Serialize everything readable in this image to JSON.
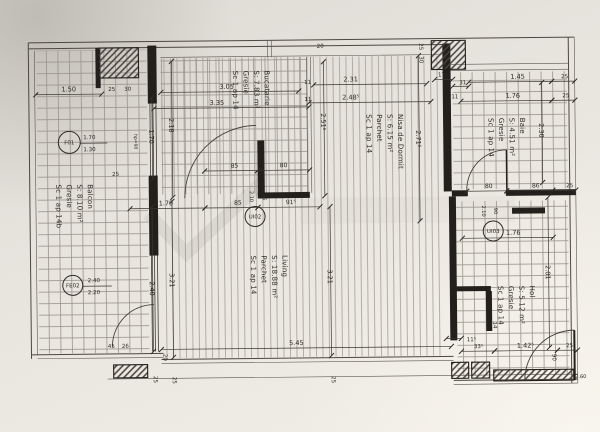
{
  "rooms": [
    {
      "id": "balcon",
      "name": "Balcon",
      "area": "S: 8.10 m²",
      "floor": "Gresie",
      "scale": "Sc 1 ap 14b",
      "x": 88,
      "y": 182
    },
    {
      "id": "bucatarie",
      "name": "Bucatarie",
      "area": "S: 7.83 m²",
      "floor": "Gresie",
      "scale": "Sc 1 ap 14",
      "x": 266,
      "y": 70
    },
    {
      "id": "nisa-de-dormit",
      "name": "Nisa de Dormit",
      "area": "S: 6.15 m²",
      "floor": "Parchet",
      "scale": "Sc 1 ap 14",
      "x": 399,
      "y": 115
    },
    {
      "id": "baie",
      "name": "Baie",
      "area": "S: 4.51 m²",
      "floor": "Gresie",
      "scale": "Sc 1 ap 14",
      "x": 521,
      "y": 120
    },
    {
      "id": "living",
      "name": "Living",
      "area": "S: 18.88 m²",
      "floor": "Parchet",
      "scale": "Sc 1 ap 14",
      "x": 282,
      "y": 255
    },
    {
      "id": "hol",
      "name": "Hol",
      "area": "S: 5.12 m²",
      "floor": "Gresie",
      "scale": "Sc 1 ap 14",
      "x": 529,
      "y": 288
    }
  ],
  "openings": [
    {
      "id": "F01",
      "cx": 70,
      "cy": 140,
      "r": 11,
      "spec": [
        "1.70",
        "1.30"
      ],
      "sx": 84
    },
    {
      "id": "FE02",
      "cx": 72,
      "cy": 283,
      "r": 10,
      "spec": [
        "2.40",
        "2.20"
      ],
      "sx": 87
    },
    {
      "id": "UI02",
      "cx": 255,
      "cy": 216,
      "r": 10
    },
    {
      "id": "UI03",
      "cx": 493,
      "cy": 233,
      "r": 10
    }
  ],
  "dims": [
    {
      "v": "1.50",
      "x1": 37,
      "y1": 92,
      "x2": 103,
      "y2": 92,
      "tx": 70,
      "ty": 89
    },
    {
      "v": "25",
      "tx": 113,
      "ty": 89,
      "s": 5.5
    },
    {
      "v": "30",
      "tx": 129,
      "ty": 89,
      "s": 5.5
    },
    {
      "v": "3.05",
      "x1": 162,
      "y1": 91,
      "x2": 300,
      "y2": 91,
      "tx": 228,
      "ty": 88
    },
    {
      "v": "3.35",
      "x1": 155,
      "y1": 107,
      "x2": 310,
      "y2": 107,
      "tx": 218,
      "ty": 104
    },
    {
      "v": "2.31",
      "x1": 315,
      "y1": 85,
      "x2": 428,
      "y2": 85,
      "tx": 352,
      "ty": 82
    },
    {
      "v": "2.48⁵",
      "x1": 310,
      "y1": 103,
      "x2": 432,
      "y2": 103,
      "tx": 352,
      "ty": 100
    },
    {
      "v": "20",
      "tx": 322,
      "ty": 48,
      "s": 5.5
    },
    {
      "v": "11",
      "tx": 309,
      "ty": 84,
      "s": 5.5
    },
    {
      "v": "11",
      "tx": 309,
      "ty": 101,
      "s": 5.5
    },
    {
      "v": "25",
      "tx": 421,
      "ty": 48,
      "r": 90,
      "s": 5.5
    },
    {
      "v": "30",
      "tx": 421,
      "ty": 61,
      "r": 90,
      "s": 5.5
    },
    {
      "v": "17⁵",
      "x1": 436,
      "y1": 81,
      "x2": 454,
      "y2": 81,
      "tx": 444,
      "ty": 78,
      "s": 5.5
    },
    {
      "v": "31",
      "x1": 454,
      "y1": 88,
      "x2": 470,
      "y2": 88,
      "tx": 464,
      "ty": 86,
      "s": 5.5
    },
    {
      "v": "11",
      "tx": 456,
      "ty": 100,
      "s": 5.5
    },
    {
      "v": "1.45",
      "x1": 470,
      "y1": 84,
      "x2": 553,
      "y2": 84,
      "tx": 519,
      "ty": 81
    },
    {
      "v": "25",
      "x1": 553,
      "y1": 84,
      "x2": 576,
      "y2": 84,
      "tx": 566,
      "ty": 81,
      "s": 5.5
    },
    {
      "v": "1.76",
      "x1": 462,
      "y1": 103,
      "x2": 553,
      "y2": 103,
      "tx": 514,
      "ty": 100
    },
    {
      "v": "25",
      "x1": 553,
      "y1": 103,
      "x2": 576,
      "y2": 103,
      "tx": 567,
      "ty": 100,
      "s": 5.5
    },
    {
      "v": "2.30",
      "x1": 543,
      "y1": 85,
      "x2": 543,
      "y2": 185,
      "tx": 540,
      "ty": 133,
      "r": 90
    },
    {
      "v": "80",
      "x1": 467,
      "y1": 193,
      "x2": 507,
      "y2": 193,
      "tx": 489,
      "ty": 190,
      "s": 6
    },
    {
      "v": "86",
      "x1": 507,
      "y1": 193,
      "x2": 553,
      "y2": 193,
      "tx": 536,
      "ty": 190,
      "s": 6
    },
    {
      "v": "25",
      "x1": 553,
      "y1": 193,
      "x2": 576,
      "y2": 193,
      "tx": 570,
      "ty": 190,
      "s": 5.5
    },
    {
      "v": "2.51⁵",
      "x1": 325,
      "y1": 62,
      "x2": 325,
      "y2": 196,
      "tx": 322,
      "ty": 122,
      "r": 90
    },
    {
      "v": "2.71⁵",
      "x1": 420,
      "y1": 57,
      "x2": 420,
      "y2": 222,
      "tx": 417,
      "ty": 140,
      "r": 90
    },
    {
      "v": "1.70",
      "x1": 153,
      "y1": 96,
      "x2": 153,
      "y2": 178,
      "tx": 150,
      "ty": 135,
      "r": 90
    },
    {
      "v": "2.18",
      "x1": 173,
      "y1": 60,
      "x2": 173,
      "y2": 196,
      "tx": 170,
      "ty": 124,
      "r": 90
    },
    {
      "v": "85",
      "x1": 205,
      "y1": 170,
      "x2": 258,
      "y2": 170,
      "tx": 235,
      "ty": 167,
      "s": 6
    },
    {
      "v": "80",
      "x1": 258,
      "y1": 170,
      "x2": 310,
      "y2": 170,
      "tx": 284,
      "ty": 167,
      "s": 6
    },
    {
      "v": "25",
      "tx": 116,
      "ty": 174,
      "s": 5.5
    },
    {
      "v": "1.70",
      "x1": 130,
      "y1": 207,
      "x2": 205,
      "y2": 207,
      "tx": 166,
      "ty": 204
    },
    {
      "v": "85",
      "x1": 205,
      "y1": 207,
      "x2": 258,
      "y2": 207,
      "tx": 238,
      "ty": 204,
      "s": 6
    },
    {
      "v": "91⁵",
      "x1": 258,
      "y1": 207,
      "x2": 320,
      "y2": 207,
      "tx": 291,
      "ty": 204,
      "s": 6
    },
    {
      "v": "2.10",
      "tx": 250,
      "ty": 196,
      "r": 90,
      "s": 5
    },
    {
      "v": "85",
      "tx": 263,
      "ty": 197,
      "r": 90,
      "s": 5
    },
    {
      "v": "3.21",
      "x1": 330,
      "y1": 207,
      "x2": 330,
      "y2": 356,
      "tx": 327,
      "ty": 277,
      "r": 90
    },
    {
      "v": "2.40",
      "x1": 152,
      "y1": 205,
      "x2": 152,
      "y2": 350,
      "tx": 149,
      "ty": 287,
      "r": 90
    },
    {
      "v": "3.21",
      "x1": 172,
      "y1": 200,
      "x2": 172,
      "y2": 356,
      "tx": 169,
      "ty": 279,
      "r": 90
    },
    {
      "v": "1.76",
      "x1": 462,
      "y1": 240,
      "x2": 553,
      "y2": 240,
      "tx": 513,
      "ty": 237
    },
    {
      "v": "2.01",
      "x1": 548,
      "y1": 200,
      "x2": 548,
      "y2": 350,
      "tx": 545,
      "ty": 275,
      "r": 90
    },
    {
      "v": "2.10",
      "tx": 482,
      "ty": 213,
      "r": 90,
      "s": 5
    },
    {
      "v": "90",
      "tx": 494,
      "ty": 213,
      "r": 90,
      "s": 5
    },
    {
      "v": "5.45",
      "x1": 160,
      "y1": 348,
      "x2": 450,
      "y2": 348,
      "tx": 295,
      "ty": 345
    },
    {
      "v": "45",
      "tx": 110,
      "ty": 346,
      "s": 5.5
    },
    {
      "v": "26",
      "tx": 124,
      "ty": 346,
      "s": 5.5
    },
    {
      "v": "20",
      "tx": 162,
      "ty": 356,
      "r": 90,
      "s": 5.5
    },
    {
      "v": "25",
      "tx": 152,
      "ty": 378,
      "r": 90,
      "s": 5.5
    },
    {
      "v": "25",
      "tx": 171,
      "ty": 379,
      "r": 90,
      "s": 5.5
    },
    {
      "v": "25",
      "tx": 330,
      "ty": 380,
      "r": 90,
      "s": 5.5
    },
    {
      "v": "15",
      "x1": 445,
      "y1": 340,
      "x2": 460,
      "y2": 340,
      "tx": 452,
      "ty": 337,
      "s": 5.5
    },
    {
      "v": "11⁵",
      "tx": 470,
      "ty": 343,
      "s": 5.5
    },
    {
      "v": "33⁵",
      "x1": 460,
      "y1": 353,
      "x2": 493,
      "y2": 353,
      "tx": 477,
      "ty": 350,
      "s": 5.5
    },
    {
      "v": "1.42⁵",
      "x1": 493,
      "y1": 353,
      "x2": 556,
      "y2": 353,
      "tx": 524,
      "ty": 350
    },
    {
      "v": "25",
      "x1": 556,
      "y1": 353,
      "x2": 576,
      "y2": 353,
      "tx": 568,
      "ty": 350,
      "s": 5.5
    },
    {
      "v": "90",
      "tx": 551,
      "ty": 360,
      "r": 90,
      "s": 5.5
    },
    {
      "v": "14",
      "tx": 492,
      "ty": 327,
      "r": 90,
      "s": 5.5
    },
    {
      "v": "2.60",
      "tx": 579,
      "ty": 381,
      "s": 5
    },
    {
      "v": "hp=90",
      "tx": 135,
      "ty": 140,
      "r": 90,
      "s": 4.5
    }
  ]
}
